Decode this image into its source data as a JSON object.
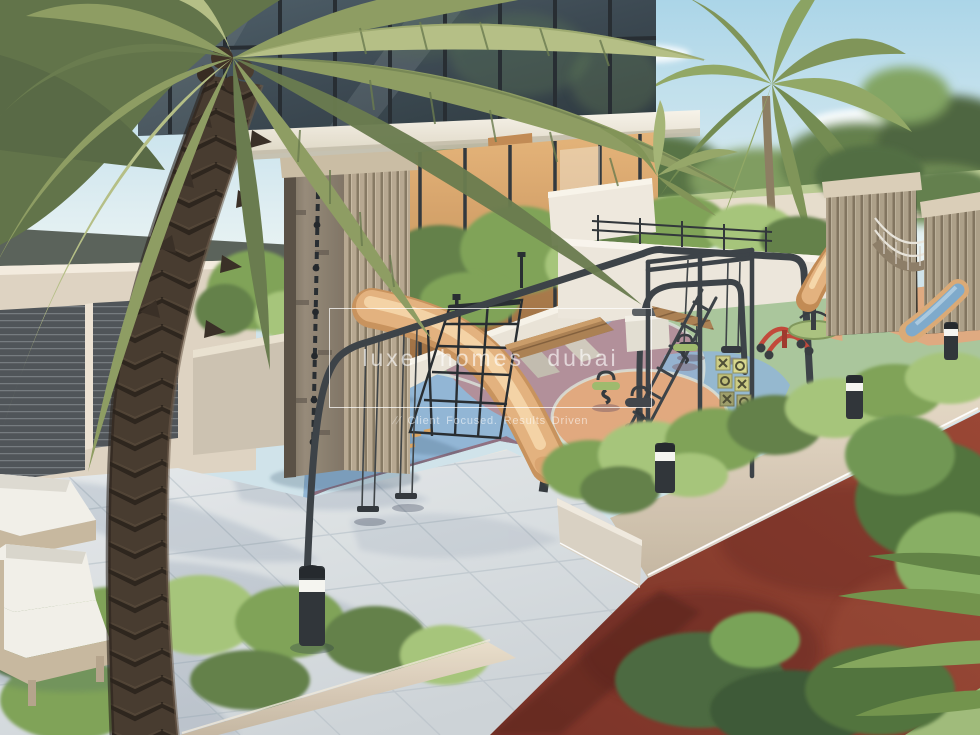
{
  "watermark": {
    "title": "luxe homes dubai",
    "prefix": "//",
    "tagline": "Client Focused. Results Driven"
  },
  "scene": {
    "type": "architectural-render-playground",
    "colors": {
      "sky_top": "#a9d4e8",
      "sky_low": "#edf5f4",
      "cloud": "#ffffff",
      "tree_far": "#67854c",
      "tree_far_dark": "#49623a",
      "lawn": "#b7c98f",
      "wall_far": "#e6dccb",
      "glass_dark": "#3c4a54",
      "glass_frame": "#22282d",
      "slab": "#f1ede3",
      "amber": "#d39a62",
      "wall_beige": "#ddd2c0",
      "gate_dark": "#4b5054",
      "planter": "#cbc1af",
      "hedge": "#5f7d45",
      "bush": "#7ba053",
      "bush_light": "#a4c477",
      "rubber_green": "#a8c599",
      "rubber_blue": "#8fb4d4",
      "rubber_mauve": "#b08d97",
      "rubber_purple": "#8d6d7e",
      "rubber_orange": "#e0a77b",
      "curb": "#e9e7df",
      "paving": "#d9dde0",
      "paving_shadow": "#52708c",
      "track": "#8a392c",
      "track_dark": "#5f241c",
      "tower_stone": "#8b7f70",
      "tower_wood": "#b5a68e",
      "wood_dark": "#84765f",
      "slide_tan": "#e3b07b",
      "slide_hi": "#f5d6a8",
      "slide_blue": "#7ba8ca",
      "equip_dark": "#373d43",
      "bench_wood": "#a97d4f",
      "concrete": "#e2ddd1",
      "red_play": "#c04435",
      "rider_green": "#9cb86a",
      "palm_green": "#8b9a5e",
      "palm_light": "#b3bd83",
      "palm_dark": "#66784a",
      "trunk": "#43362a",
      "trunk_dark": "#2a211a",
      "bollard": "#2b3034",
      "led": "#ffffff",
      "cushion": "#f1efe8",
      "frame_beige": "#c6b69c",
      "grass": "#9db977"
    }
  }
}
